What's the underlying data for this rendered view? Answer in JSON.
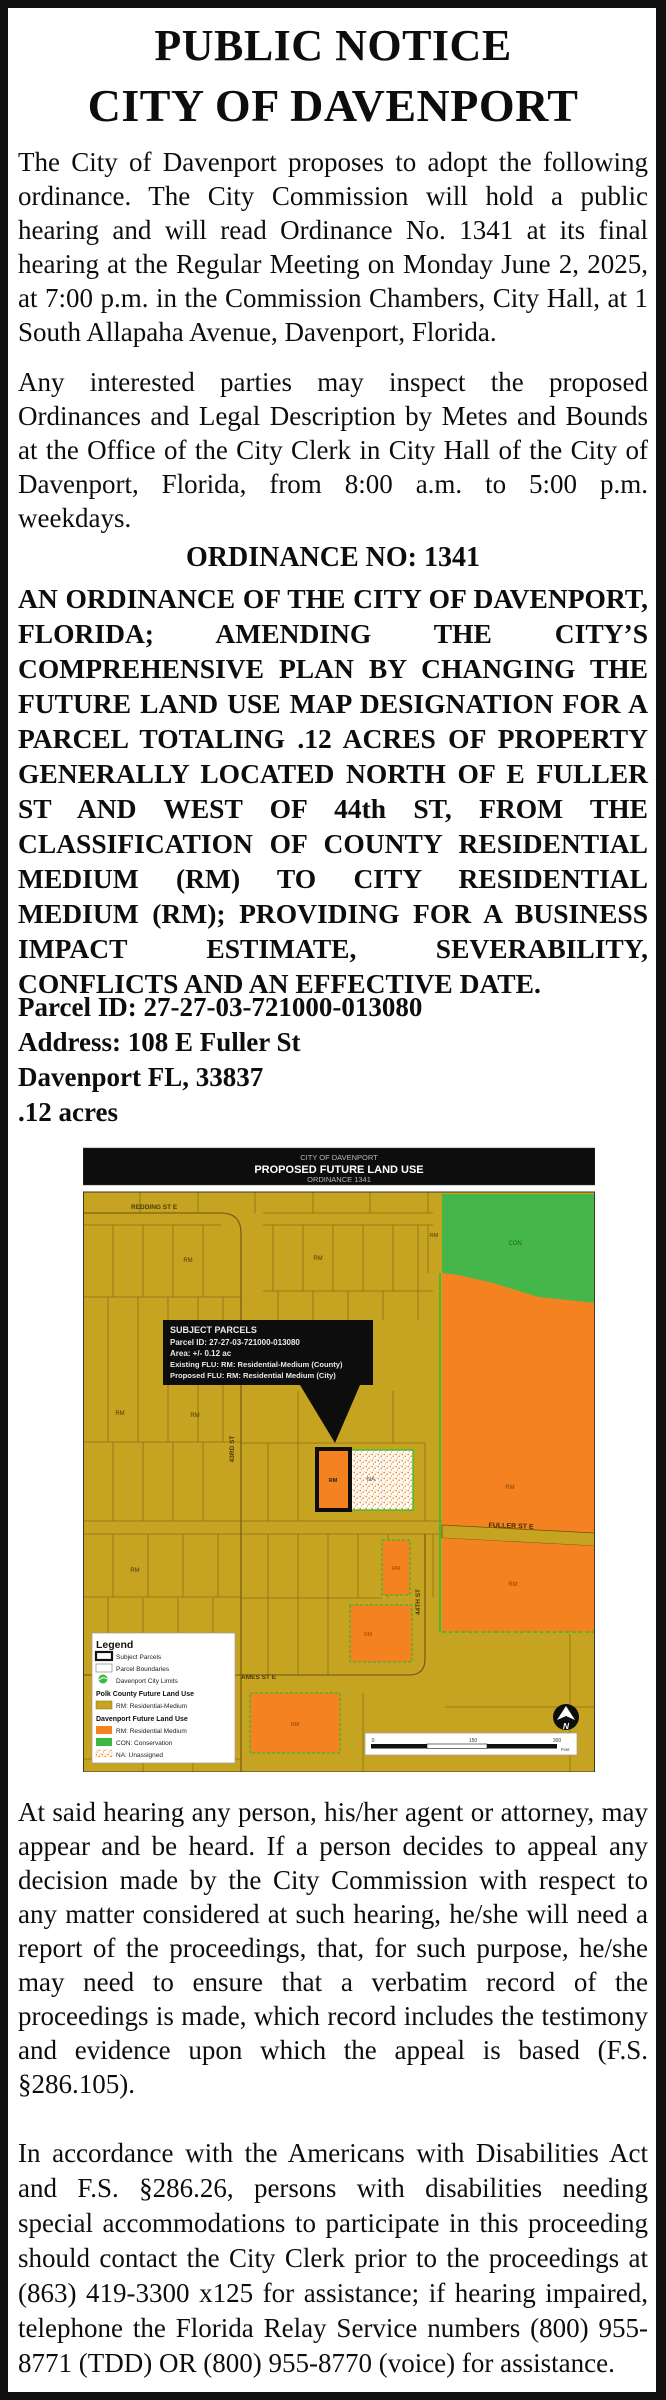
{
  "notice": {
    "title_line1": "PUBLIC NOTICE",
    "title_line2": "CITY OF DAVENPORT",
    "para1": "The City of Davenport proposes to adopt the following ordinance.  The City Commission will hold a public hearing and will read Ordinance No. 1341 at its final hearing at the Regular Meeting on Monday June 2, 2025, at 7:00 p.m. in the Commission Chambers, City Hall, at 1 South Allapaha Avenue, Davenport, Florida.",
    "para2": "Any interested parties may inspect the proposed Ordinances and Legal Description by Metes and Bounds at the Office of the City Clerk in City Hall of the City of Davenport, Florida, from 8:00 a.m. to 5:00 p.m. weekdays.",
    "ordinance_heading": "ORDINANCE NO: 1341",
    "ordinance_body": "AN ORDINANCE OF THE CITY OF DAVENPORT, FLORIDA; AMENDING THE CITY’S COMPREHENSIVE PLAN BY CHANGING THE FUTURE LAND USE MAP DESIGNATION FOR A PARCEL TOTALING .12 ACRES OF PROPERTY GENERALLY LOCATED NORTH OF E FULLER ST AND WEST OF 44th ST, FROM THE CLASSIFICATION OF COUNTY RESIDENTIAL MEDIUM (RM) TO CITY RESIDENTIAL MEDIUM (RM); PROVIDING FOR A BUSINESS IMPACT ESTIMATE, SEVERABILITY, CONFLICTS AND AN EFFECTIVE DATE.",
    "parcel": {
      "parcel_id": "Parcel ID: 27-27-03-721000-013080",
      "address": "Address: 108 E Fuller St",
      "city_state_zip": "Davenport FL, 33837",
      "acreage": ".12 acres"
    },
    "para3": "At said hearing any person, his/her agent or attorney, may appear and be heard.  If a person decides to appeal any decision made by the City Commission with respect to any matter considered at such hearing, he/she will need a report of the proceedings, that, for such purpose, he/she may need to ensure that a verbatim record of the proceedings is made, which record includes the testimony and evidence upon which the appeal is based (F.S. §286.105).",
    "para4": "In accordance with the Americans with Disabilities Act and F.S. §286.26, persons with disabilities needing special accommodations to participate in this proceeding should contact the City Clerk prior to the proceedings at (863) 419-3300 x125 for assistance; if hearing impaired, telephone the Florida Relay Service numbers (800) 955-8771 (TDD) OR (800) 955-8770 (voice) for assistance."
  },
  "map": {
    "header": {
      "line1": "CITY OF DAVENPORT",
      "line2": "PROPOSED FUTURE LAND USE",
      "line3": "ORDINANCE 1341"
    },
    "callout": {
      "title": "SUBJECT PARCELS",
      "parcel_id": "Parcel ID: 27-27-03-721000-013080",
      "area": "Area: +/- 0.12 ac",
      "existing_flu": "Existing FLU: RM: Residential-Medium (County)",
      "proposed_flu": "Proposed FLU: RM: Residential Medium (City)"
    },
    "streets": {
      "redding": "REDDING ST E",
      "st43": "43RD ST",
      "fuller": "FULLER ST E",
      "st44": "44TH ST",
      "ames": "AMES ST E"
    },
    "labels": {
      "rm": "RM",
      "con": "CON",
      "na": "NA"
    },
    "legend": {
      "title": "Legend",
      "item_subject": "Subject Parcels",
      "item_parcel": "Parcel Boundaries",
      "item_limits": "Davenport City Limits",
      "heading_county": "Polk County Future Land Use",
      "item_county_rm": "RM: Residential-Medium",
      "heading_city": "Davenport Future Land Use",
      "item_city_rm": "RM: Residential Medium",
      "item_con": "CON: Conservation",
      "item_na": "NA: Unassigned"
    },
    "scale": {
      "start": "0",
      "mid": "150",
      "end": "300",
      "unit": "Feet"
    },
    "north_label": "N",
    "colors": {
      "county_rm": "#C7A322",
      "city_rm": "#F58220",
      "conservation": "#45B649",
      "city_limits_line": "#2EBD2E",
      "road_line": "#8A6F15",
      "callout_bg": "#0D0D0D"
    }
  }
}
